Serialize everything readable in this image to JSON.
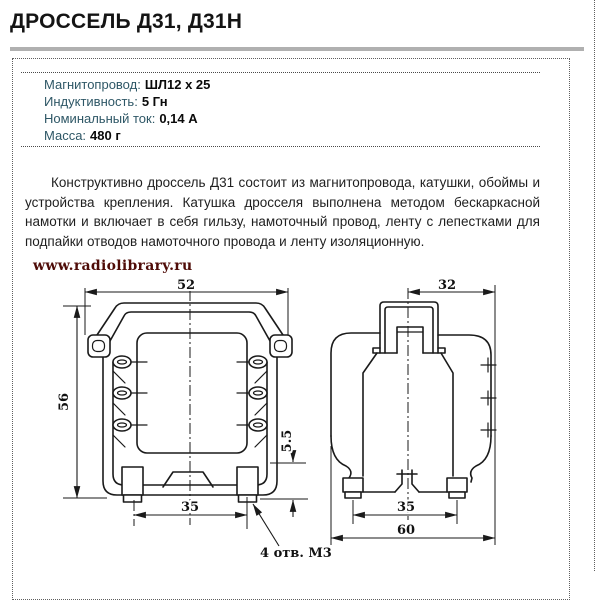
{
  "page": {
    "title": "ДРОССЕЛЬ Д31, Д31Н",
    "watermark": "www.radiolibrary.ru"
  },
  "specs": {
    "items": [
      {
        "label": "Магнитопровод:",
        "value": "ШЛ12 х 25"
      },
      {
        "label": "Индуктивность:",
        "value": "5 Гн"
      },
      {
        "label": "Номинальный ток:",
        "value": "0,14 А"
      },
      {
        "label": "Масса:",
        "value": "480 г"
      }
    ]
  },
  "description": {
    "text": "Конструктивно дроссель Д31 состоит из магнитопровода, катушки, обоймы и устройства крепления. Катушка дросселя выполнена методом бескаркасной намотки и включает в себя гильзу, намоточный провод, ленту с лепестками для подпайки отводов намоточного провода и ленту изоляционную."
  },
  "drawing": {
    "front_view": {
      "width_mm": "52",
      "height_mm": "56",
      "mount_spacing_mm": "35",
      "foot_step_mm": "5.5",
      "holes_note": "4 отв. М3"
    },
    "side_view": {
      "half_width_mm": "32",
      "mount_spacing_mm": "35",
      "depth_mm": "60"
    }
  },
  "colors": {
    "spec_label": "#2e5766",
    "spec_value": "#0a0a0a",
    "watermark": "#4f0c08",
    "divider_rule": "#b0b0b0",
    "dotted_border": "#5f5f5f",
    "drawing_ink": "#1a1a1a"
  }
}
